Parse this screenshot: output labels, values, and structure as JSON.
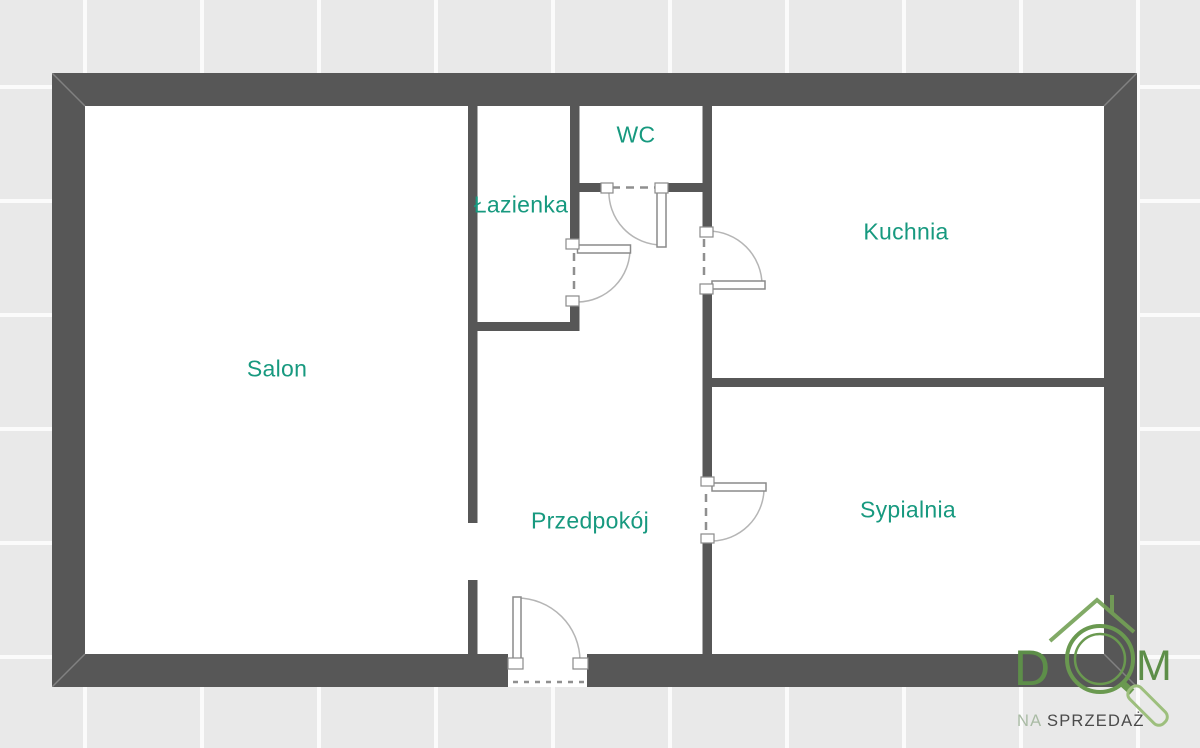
{
  "rooms": {
    "salon": {
      "label": "Salon"
    },
    "lazienka": {
      "label": "Łazienka"
    },
    "wc": {
      "label": "WC"
    },
    "kuchnia": {
      "label": "Kuchnia"
    },
    "przedpokoj": {
      "label": "Przedpokój"
    },
    "sypialnia": {
      "label": "Sypialnia"
    }
  },
  "logo": {
    "letter_d": "D",
    "letter_m": "M",
    "tagline_na": "NA",
    "tagline_sprzedaz": "SPRZEDAŻ"
  },
  "colors": {
    "wall": "#575757",
    "floor": "#ffffff",
    "tile": "#e9e9e9",
    "room_label": "#17997f",
    "logo_green": "#6a9950",
    "logo_green_light": "#9dbf7d",
    "tagline_na_gray_green": "#a9bba4",
    "tagline_dark_gray": "#4a4a4a",
    "door_arc": "#b5b5b5",
    "door_dash": "#8f8f8f"
  }
}
